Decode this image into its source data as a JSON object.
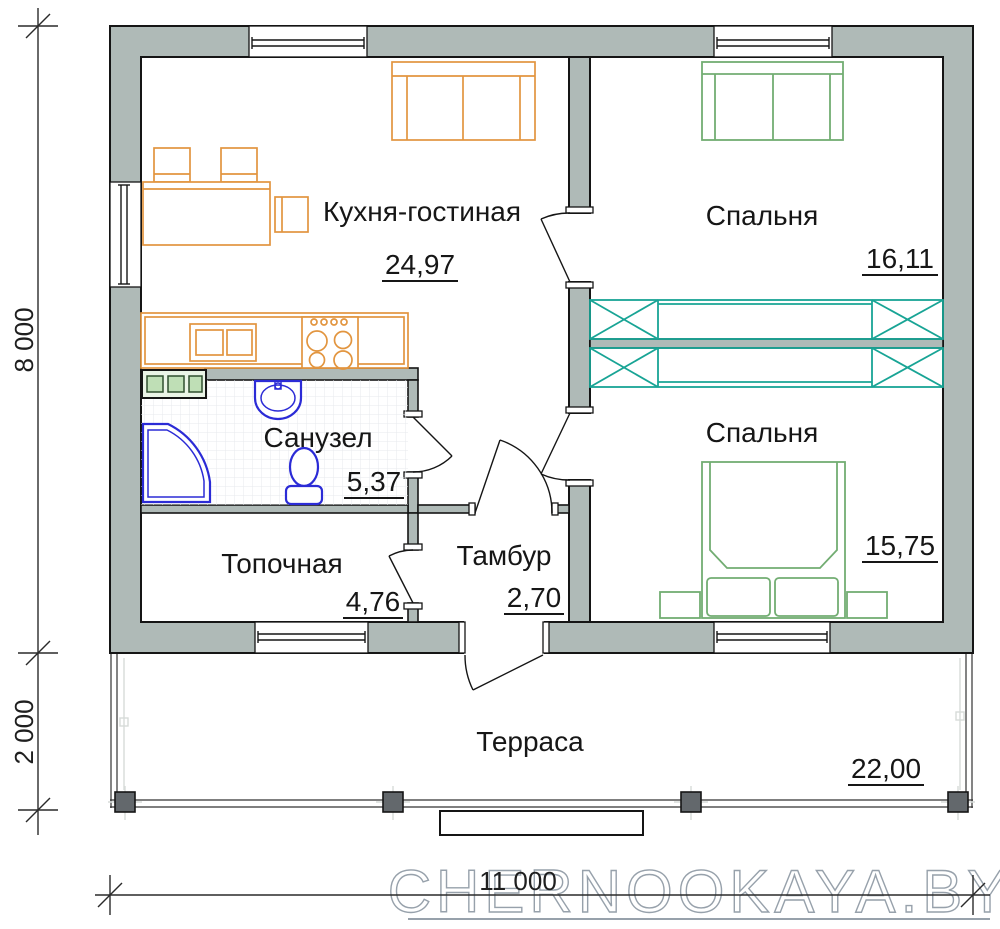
{
  "watermark": "CHERNOOKAYA.BY",
  "rooms": [
    {
      "id": "kitchen-living",
      "label": "Кухня-гостиная",
      "area": "24,97"
    },
    {
      "id": "bedroom-1",
      "label": "Спальня",
      "area": "16,11"
    },
    {
      "id": "bedroom-2",
      "label": "Спальня",
      "area": "15,75"
    },
    {
      "id": "bathroom",
      "label": "Санузел",
      "area": "5,37"
    },
    {
      "id": "boiler-room",
      "label": "Топочная",
      "area": "4,76"
    },
    {
      "id": "vestibule",
      "label": "Тамбур",
      "area": "2,70"
    },
    {
      "id": "terrace",
      "label": "Терраса",
      "area": "22,00"
    }
  ],
  "dimensions": {
    "left_top": "8 000",
    "left_bottom": "2 000",
    "bottom": "11 000"
  },
  "colors": {
    "wall_fill": "#afbab7",
    "outline": "#151515",
    "furniture_orange": "#e2953f",
    "furniture_green": "#72ad72",
    "wardrobe_teal": "#18a495",
    "plumbing_blue": "#2b2bd6",
    "watermark_gray": "#97a1ab"
  }
}
